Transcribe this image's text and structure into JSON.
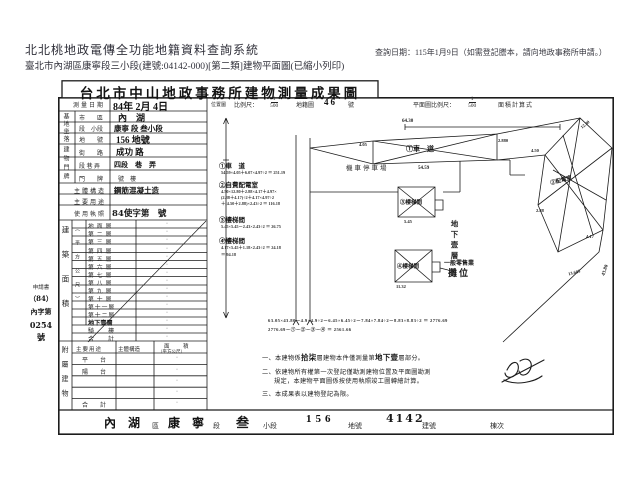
{
  "header": {
    "system_title": "北北桃地政電傳全功能地籍資料查詢系統",
    "query_date": "查詢日期：115年1月9日（如需登記謄本，請向地政事務所申請。）",
    "doc_line": "臺北市內湖區康寧段三小段(建號:04142-000)[第二類]建物平面圖(已縮小列印)"
  },
  "doc": {
    "title": "台北市中山地政事務所建物測量成果圖",
    "left": {
      "dot": "·",
      "date_label": "測量日期",
      "date_value": "84年 2月 4日",
      "site_group_label": "基地坐落",
      "site_rows": [
        {
          "label": "市　　區",
          "value": "內　湖"
        },
        {
          "label": "段　小段",
          "value": "康寧 段 叁小段"
        },
        {
          "label": "地　　號",
          "value": "156 地號"
        }
      ],
      "door_group_label": "建物門牌",
      "door_rows": [
        {
          "label": "街　　路",
          "value": "成功 路"
        },
        {
          "label": "段 巷 弄",
          "value": "四段　巷　弄"
        },
        {
          "label": "門　　牌",
          "value": "號　樓"
        }
      ],
      "structure_label": "主體構造",
      "structure_value": "鋼筋混凝土造",
      "usage_label": "主要用途",
      "usage_value": "",
      "license_label": "使用執照",
      "license_value": "84使字第　號",
      "floor_group_label": "建築面積",
      "floor_unit": "（平方公尺）",
      "floors": [
        "地面層",
        "第二層",
        "第三層",
        "第四層",
        "第五層",
        "第六層",
        "第七層",
        "第八層",
        "第九層",
        "第十層",
        "第十一層",
        "第十二層",
        "地下壹層"
      ],
      "qilou": "騎　樓",
      "total": "合　計",
      "attached_group_label": "附屬建物",
      "attached_h1": "主要用途",
      "attached_h2": "主體構造",
      "attached_h3": "面　積",
      "attached_h4": "（平方公尺）",
      "attached_rows": [
        "平　台",
        "陽　台",
        "",
        "",
        "合　計"
      ],
      "application": {
        "printed": "申請書",
        "l1": "（84）",
        "l2": "內字第",
        "l3": "0254",
        "l4": "號"
      }
    },
    "map": {
      "loc_label": "位置圖",
      "scale_label": "比例尺：",
      "scale_num": "1",
      "scale_den": "500",
      "sheet_label": "地籍圖",
      "sheet_no": "46",
      "sheet_suffix": "號",
      "plan_scale_label": "平面圖比例尺：",
      "plan_num": "1",
      "plan_den": "500",
      "calc_label": "面積計算式",
      "annotations": [
        {
          "title": "①車　道",
          "calcs": [
            "54.59×4.05＋6.07×4.97÷2 ＝ 251.19"
          ]
        },
        {
          "title": "②自費配電室",
          "calcs": [
            "4.50×12.80＋2.88×4.17＋4.97×",
            "(2.88＋4.17)÷2＋4.17×4.97÷2",
            "＋(4.50＋2.88)×2.43÷2 ＝ 116.18"
          ]
        },
        {
          "title": "③樓梯間",
          "calcs": [
            "5.45×5.45－2.43×2.43÷2 ＝ 26.75"
          ]
        },
        {
          "title": "④樓梯間",
          "calcs": [
            "4.17×5.45＋1.18×2.43÷2 ＝ 24.18",
            "＝ 94.18"
          ]
        }
      ],
      "labels": {
        "ramp": "①車　道",
        "parking": "機車停車場",
        "stair3": "③樓梯間",
        "stair4": "④樓梯間",
        "power": "②配電室",
        "basement": "地下壹層",
        "retail1": "一般零售業",
        "retail2": "攤位"
      },
      "dims": {
        "d1": "64.30",
        "d2": "4.05",
        "d3": "54.59",
        "d4": "2.880",
        "d5": "12.80",
        "d6": "4.50",
        "d7": "2.88",
        "d8": "4.17",
        "d9": "43.80",
        "d10": "5.45",
        "d11": "11.32",
        "d12": "13.685"
      },
      "calc_lines": [
        "63.05×43.80－4.9×4.9÷2－6.45×6.45÷2－7.84×7.84÷2－8.83×8.83÷2 ＝ 2776.69",
        "2776.69－①－②－③－④ ＝ 2561.66"
      ],
      "notes": {
        "n1a": "一、本建物係",
        "n1b": "拾柒",
        "n1c": "層建物本件僅測量第",
        "n1d": "地下壹",
        "n1e": "層部分。",
        "n2a": "二、依建物所有權第一次登記僅勘測建物位置及平面圖勘測",
        "n2b": "規定，本建物平面圖係按使用執照竣工圖轉繪計算。",
        "n3": "三、本成果表以建物登記為限。"
      }
    },
    "footer": {
      "district_value": "內　湖",
      "district_label": "區",
      "section_value": "康　寧",
      "section_label": "段",
      "subsection_value": "叁",
      "subsection_label": "小段",
      "parcel_value": "156",
      "parcel_label": "地號",
      "building_value": "4142",
      "building_label": "建號",
      "unit_label": "棟次"
    }
  }
}
